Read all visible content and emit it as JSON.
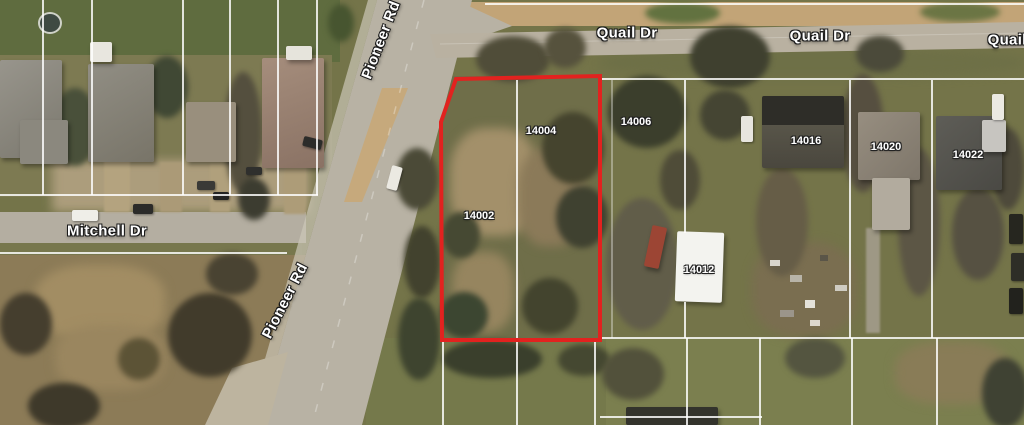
{
  "map": {
    "kind": "aerial-satellite-parcel-view",
    "road_labels": [
      {
        "id": "pioneer-rd-top",
        "text": "Pioneer Rd"
      },
      {
        "id": "pioneer-rd-bottom",
        "text": "Pioneer Rd"
      },
      {
        "id": "quail-dr-1",
        "text": "Quail Dr"
      },
      {
        "id": "quail-dr-2",
        "text": "Quail Dr"
      },
      {
        "id": "quail-dr-3",
        "text": "Quail Dr"
      },
      {
        "id": "mitchell-dr",
        "text": "Mitchell Dr"
      }
    ],
    "parcel_labels": [
      {
        "id": "14002"
      },
      {
        "id": "14004"
      },
      {
        "id": "14006"
      },
      {
        "id": "14012"
      },
      {
        "id": "14016"
      },
      {
        "id": "14020"
      },
      {
        "id": "14022"
      }
    ],
    "highlight_outline": {
      "color": "#e2221f",
      "meaning": "subject property boundary (lots 14002 & 14004)"
    },
    "parcel_line_color": "#ffffff"
  }
}
